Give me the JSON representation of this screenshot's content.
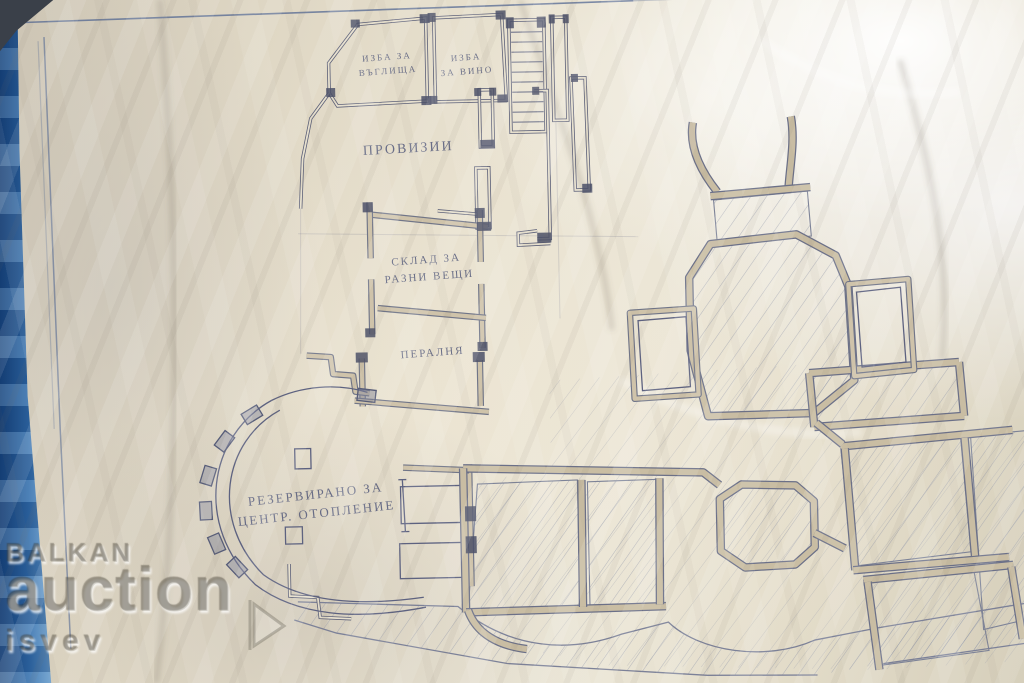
{
  "plan": {
    "labels": {
      "cellar_coal": {
        "line1": "ИЗБА ЗА",
        "line2": "ВЪГЛИЩА"
      },
      "cellar_wine": {
        "line1": "ИЗБА",
        "line2": "ЗА ВИНО"
      },
      "provisions": "ПРОВИЗИИ",
      "storage": {
        "line1": "СКЛАД ЗА",
        "line2": "РАЗНИ ВЕЩИ"
      },
      "laundry": "ПЕРАЛНЯ",
      "heating": {
        "line1": "РЕЗЕРВИРАНО ЗА",
        "line2": "ЦЕНТР. ОТОПЛЕНИЕ"
      }
    },
    "colors": {
      "ink": "#565c78",
      "wall_fill": "#c9bda3",
      "hatch": "#8d93a8",
      "paper": "#e3dac6",
      "blue_edge": "#2f6cab"
    }
  },
  "watermark": {
    "brand_top": "BALKAN",
    "brand_main": "auction",
    "brand_sub": "isvev",
    "play_icon": "play-triangle"
  }
}
